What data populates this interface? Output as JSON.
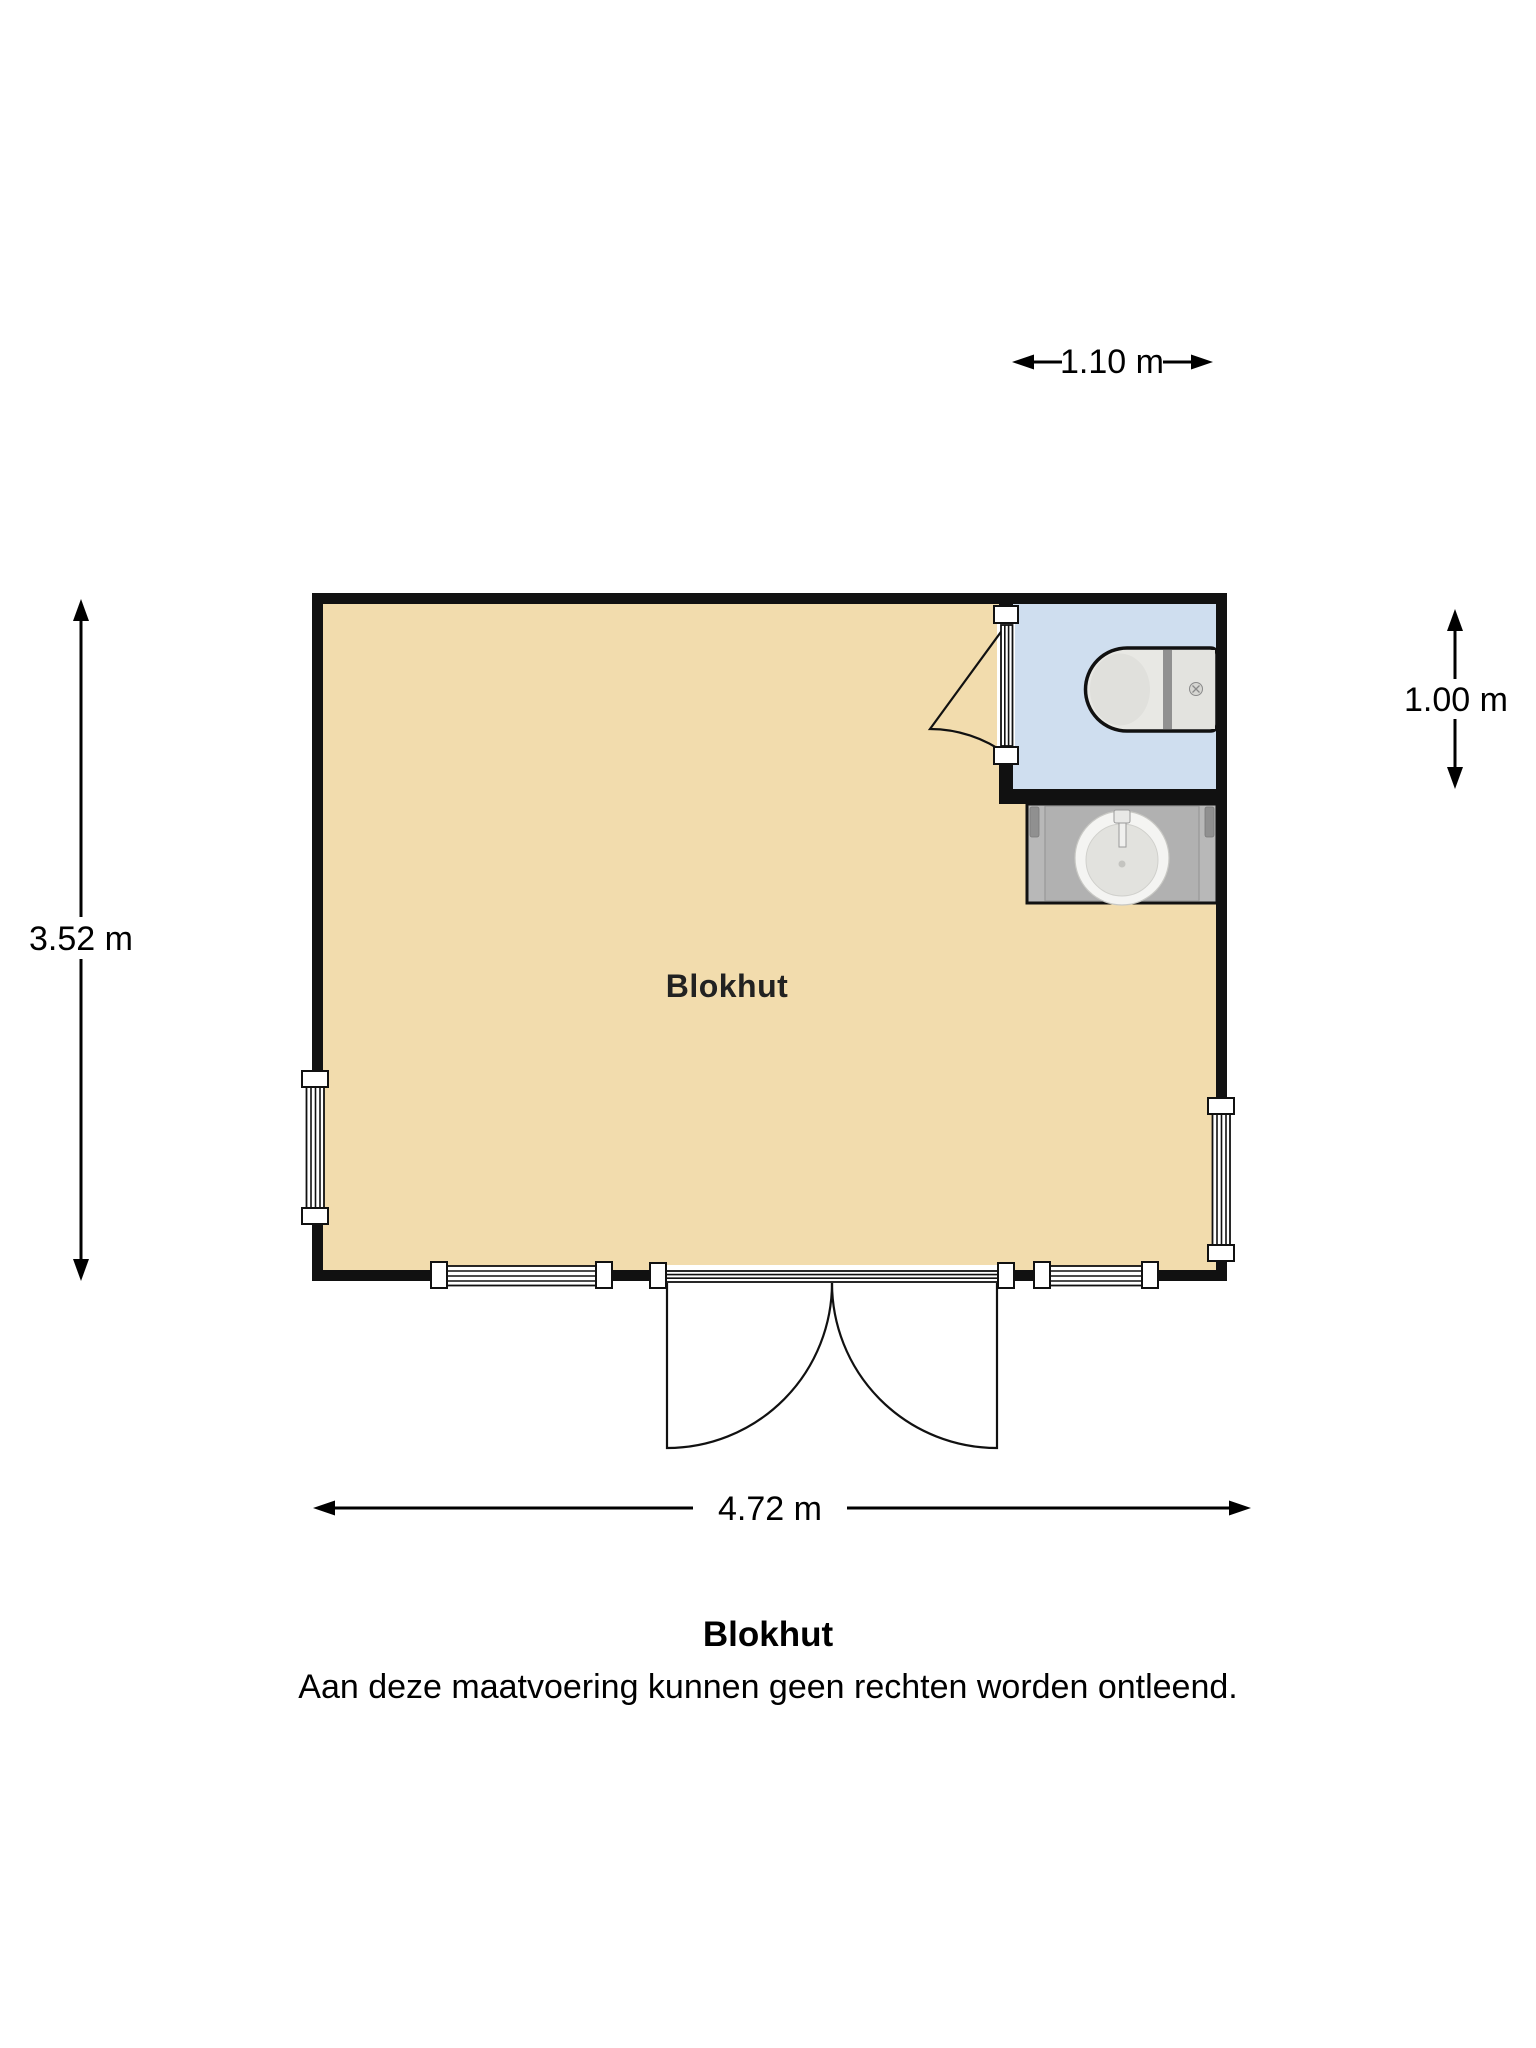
{
  "floor_plan": {
    "room_label": "Blokhut",
    "caption": {
      "title": "Blokhut",
      "disclaimer": "Aan deze maatvoering kunnen geen rechten worden ontleend."
    },
    "dimensions": {
      "bathroom_width": "1.10 m",
      "bathroom_depth": "1.00 m",
      "building_depth": "3.52 m",
      "building_width": "4.72 m"
    },
    "fixtures": [
      "toilet-icon",
      "sink-icon"
    ],
    "colors": {
      "floor": "#f2dcad",
      "bathroom_floor": "#cfdeef",
      "counter": "#b8b8b8",
      "wall": "#111111",
      "background": "#ffffff"
    }
  }
}
